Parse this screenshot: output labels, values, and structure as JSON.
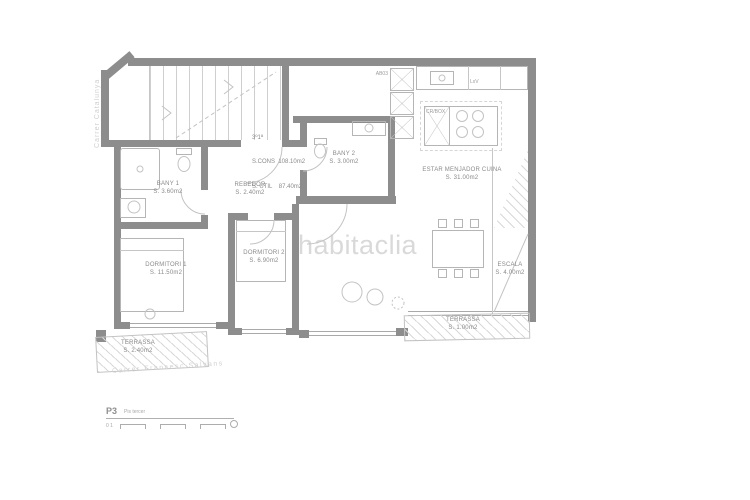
{
  "watermark": "habitaclia",
  "streets": {
    "left": "Carrer Catalunya",
    "bottom": "Carrer Francesc Salvans"
  },
  "unit": {
    "floor": "3º1ª",
    "built_area": "S.CONS  108.10m2",
    "useful_area": "S. ÚTIL    87.40m2"
  },
  "rooms": {
    "bany1": {
      "name": "BANY 1",
      "area": "S. 3.60m2"
    },
    "bany2": {
      "name": "BANY 2",
      "area": "S. 3.00m2"
    },
    "rebedor": {
      "name": "REBEDOR",
      "area": "S. 2.40m2"
    },
    "dormitori1": {
      "name": "DORMITORI 1",
      "area": "S. 11.50m2"
    },
    "dormitori2": {
      "name": "DORMITORI 2",
      "area": "S. 6.90m2"
    },
    "estar": {
      "name": "ESTAR MENJADOR CUINA",
      "area": "S. 31.00m2"
    },
    "escala": {
      "name": "ESCALA",
      "area": "S. 4.00m2"
    },
    "terrassa_right": {
      "name": "TERRASSA",
      "area": "S. 1.00m2"
    },
    "terrassa_left": {
      "name": "TERRASSA",
      "area": "S. 2.40m2"
    }
  },
  "fixtures": {
    "tall_unit": "AB03",
    "washer": "LxV",
    "island": "CR/BOX"
  },
  "legend": {
    "code": "P3",
    "label": "Pis tercer",
    "ticks": "0 1"
  },
  "colors": {
    "wall": "#8d8d8d",
    "line": "#b5b5b5",
    "label": "#8a8a8a",
    "street": "#d0d0d0",
    "watermark": "#c6c6c6"
  }
}
